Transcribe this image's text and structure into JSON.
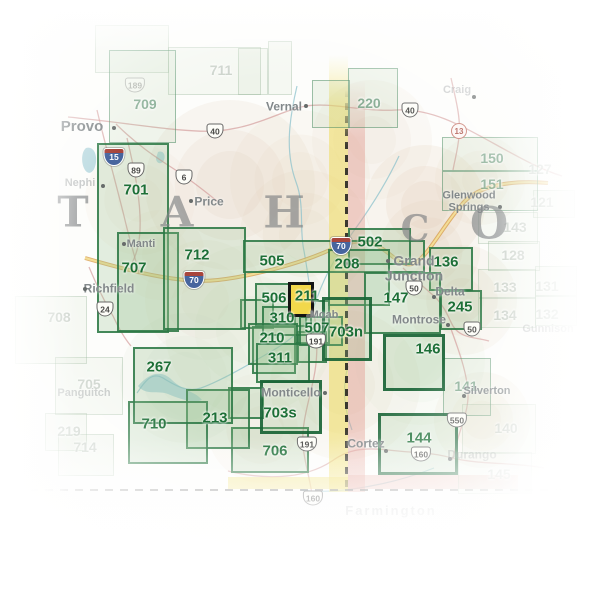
{
  "map": {
    "selected_map": "211",
    "colors": {
      "box_border": "#2c7a47",
      "box_label": "#1d6f37",
      "highlight_fill": "#f2d84b",
      "highlight_border": "#141414",
      "state_line_yellow": "#efdc5e",
      "state_line_pink": "#e2978c",
      "interstate_road": "#d79a46",
      "us_road": "#cf8f8f",
      "river": "#86bfca",
      "city_text": "#82888a",
      "state_letter": "#808385"
    },
    "state_letters": [
      {
        "char": "T",
        "x": 73,
        "y": 212,
        "size": 42
      },
      {
        "char": "A",
        "x": 177,
        "y": 212,
        "size": 42
      },
      {
        "char": "H",
        "x": 284,
        "y": 213,
        "size": 44
      },
      {
        "char": "C",
        "x": 415,
        "y": 229,
        "size": 36
      },
      {
        "char": "O",
        "x": 489,
        "y": 224,
        "size": 44
      }
    ],
    "boxes": [
      {
        "label": "711",
        "x": 168,
        "y": 47,
        "w": 93,
        "h": 48,
        "lx": 221,
        "ly": 70,
        "style": "ghost"
      },
      {
        "label": "705",
        "x": 55,
        "y": 357,
        "w": 68,
        "h": 58,
        "lx": 89,
        "ly": 384,
        "style": "ghost"
      },
      {
        "label": "708",
        "x": 15,
        "y": 296,
        "w": 72,
        "h": 68,
        "lx": 59,
        "ly": 317,
        "style": "ghost"
      },
      {
        "label": "219",
        "x": 45,
        "y": 413,
        "w": 42,
        "h": 38,
        "lx": 69,
        "ly": 431,
        "style": "ghost"
      },
      {
        "label": "714",
        "x": 58,
        "y": 434,
        "w": 56,
        "h": 42,
        "lx": 85,
        "ly": 447,
        "style": "ghost"
      },
      {
        "label": "143",
        "x": 478,
        "y": 212,
        "w": 60,
        "h": 32,
        "lx": 515,
        "ly": 227,
        "style": "ghost"
      },
      {
        "label": "128",
        "x": 488,
        "y": 241,
        "w": 52,
        "h": 30,
        "lx": 513,
        "ly": 255,
        "style": "ghost"
      },
      {
        "label": "133",
        "x": 478,
        "y": 269,
        "w": 58,
        "h": 29,
        "lx": 505,
        "ly": 287,
        "style": "ghost"
      },
      {
        "label": "134",
        "x": 478,
        "y": 298,
        "w": 58,
        "h": 30,
        "lx": 505,
        "ly": 315,
        "style": "ghost"
      },
      {
        "label": "140",
        "x": 462,
        "y": 404,
        "w": 74,
        "h": 50,
        "lx": 506,
        "ly": 428,
        "style": "ghost"
      },
      {
        "label": "145",
        "x": 458,
        "y": 452,
        "w": 74,
        "h": 42,
        "lx": 499,
        "ly": 474,
        "style": "ghost"
      },
      {
        "label": "121",
        "lx": 542,
        "ly": 202,
        "style": "label-only"
      },
      {
        "label": "127",
        "lx": 540,
        "ly": 169,
        "style": "label-only"
      },
      {
        "label": "131",
        "lx": 547,
        "ly": 286,
        "style": "label-only"
      },
      {
        "label": "132",
        "lx": 547,
        "ly": 314,
        "style": "label-only"
      },
      {
        "label": "709",
        "x": 109,
        "y": 50,
        "w": 67,
        "h": 93,
        "lx": 145,
        "ly": 104,
        "style": "medium"
      },
      {
        "label": "220",
        "x": 348,
        "y": 68,
        "w": 50,
        "h": 60,
        "lx": 369,
        "ly": 103,
        "style": "medium"
      },
      {
        "label": "150",
        "x": 442,
        "y": 137,
        "w": 96,
        "h": 34,
        "lx": 492,
        "ly": 158,
        "style": "medium"
      },
      {
        "label": "151",
        "x": 442,
        "y": 171,
        "w": 96,
        "h": 40,
        "lx": 492,
        "ly": 184,
        "style": "medium"
      },
      {
        "label": "141",
        "x": 443,
        "y": 358,
        "w": 48,
        "h": 58,
        "lx": 466,
        "ly": 386,
        "style": "medium"
      },
      {
        "label": "245",
        "x": 440,
        "y": 290,
        "w": 42,
        "h": 40,
        "lx": 460,
        "ly": 307,
        "style": "bold"
      },
      {
        "label": "701",
        "x": 97,
        "y": 143,
        "w": 72,
        "h": 190,
        "lx": 136,
        "ly": 190,
        "style": "bold"
      },
      {
        "label": "707",
        "x": 117,
        "y": 232,
        "w": 62,
        "h": 100,
        "lx": 134,
        "ly": 268,
        "style": "bold"
      },
      {
        "label": "712",
        "x": 163,
        "y": 227,
        "w": 83,
        "h": 103,
        "lx": 197,
        "ly": 255,
        "style": "bold"
      },
      {
        "label": "505",
        "x": 243,
        "y": 240,
        "w": 182,
        "h": 33,
        "lx": 272,
        "ly": 261,
        "style": "bold"
      },
      {
        "label": "502",
        "x": 348,
        "y": 228,
        "w": 63,
        "h": 37,
        "lx": 370,
        "ly": 242,
        "style": "bold"
      },
      {
        "label": "208",
        "x": 328,
        "y": 249,
        "w": 62,
        "h": 57,
        "lx": 347,
        "ly": 264,
        "style": "bold"
      },
      {
        "label": "136",
        "x": 429,
        "y": 247,
        "w": 44,
        "h": 44,
        "lx": 446,
        "ly": 262,
        "style": "bold"
      },
      {
        "label": "147",
        "x": 364,
        "y": 272,
        "w": 77,
        "h": 62,
        "lx": 396,
        "ly": 298,
        "style": "bold"
      },
      {
        "label": "146",
        "x": 383,
        "y": 334,
        "w": 62,
        "h": 57,
        "lx": 428,
        "ly": 349,
        "style": "thick"
      },
      {
        "label": "144",
        "x": 378,
        "y": 413,
        "w": 80,
        "h": 62,
        "lx": 419,
        "ly": 438,
        "style": "thick"
      },
      {
        "label": "506",
        "x": 255,
        "y": 283,
        "w": 52,
        "h": 44,
        "lx": 274,
        "ly": 298,
        "style": "bold"
      },
      {
        "label": "310",
        "x": 262,
        "y": 306,
        "w": 50,
        "h": 30,
        "lx": 282,
        "ly": 318,
        "style": "bold"
      },
      {
        "label": "210",
        "x": 248,
        "y": 323,
        "w": 50,
        "h": 42,
        "lx": 272,
        "ly": 338,
        "style": "bold"
      },
      {
        "label": "311",
        "x": 256,
        "y": 343,
        "w": 54,
        "h": 40,
        "lx": 280,
        "ly": 358,
        "style": "bold"
      },
      {
        "label": "507",
        "x": 299,
        "y": 316,
        "w": 44,
        "h": 30,
        "lx": 317,
        "ly": 328,
        "style": "bold"
      },
      {
        "label": "703n",
        "x": 322,
        "y": 297,
        "w": 50,
        "h": 64,
        "lx": 346,
        "ly": 332,
        "style": "thick"
      },
      {
        "label": "703s",
        "x": 260,
        "y": 380,
        "w": 62,
        "h": 54,
        "lx": 280,
        "ly": 413,
        "style": "thick"
      },
      {
        "label": "706",
        "x": 231,
        "y": 427,
        "w": 78,
        "h": 46,
        "lx": 275,
        "ly": 451,
        "style": "bold"
      },
      {
        "label": "213",
        "x": 186,
        "y": 389,
        "w": 64,
        "h": 60,
        "lx": 215,
        "ly": 418,
        "style": "bold"
      },
      {
        "label": "710",
        "x": 128,
        "y": 401,
        "w": 80,
        "h": 63,
        "lx": 154,
        "ly": 424,
        "style": "bold"
      },
      {
        "label": "267",
        "x": 133,
        "y": 347,
        "w": 100,
        "h": 77,
        "lx": 159,
        "ly": 367,
        "style": "bold"
      }
    ],
    "highlight": {
      "label": "211",
      "x": 288,
      "y": 282,
      "w": 26,
      "h": 35,
      "lx": 307,
      "ly": 296
    },
    "decor_rects": [
      {
        "x": 240,
        "y": 299,
        "w": 34,
        "h": 30,
        "style": "bold"
      },
      {
        "x": 294,
        "y": 300,
        "w": 36,
        "h": 44,
        "style": "bold"
      },
      {
        "x": 252,
        "y": 326,
        "w": 44,
        "h": 48,
        "style": "bold"
      },
      {
        "x": 297,
        "y": 331,
        "w": 30,
        "h": 32,
        "style": "bold"
      },
      {
        "x": 228,
        "y": 387,
        "w": 36,
        "h": 32,
        "style": "bold"
      },
      {
        "x": 312,
        "y": 80,
        "w": 38,
        "h": 48,
        "style": "medium"
      },
      {
        "x": 238,
        "y": 48,
        "w": 30,
        "h": 47,
        "style": "ghost"
      },
      {
        "x": 268,
        "y": 41,
        "w": 24,
        "h": 54,
        "style": "ghost"
      },
      {
        "x": 95,
        "y": 25,
        "w": 74,
        "h": 48,
        "style": "ghost"
      },
      {
        "x": 533,
        "y": 190,
        "w": 42,
        "h": 28,
        "style": "ghost"
      },
      {
        "x": 535,
        "y": 266,
        "w": 42,
        "h": 30,
        "style": "ghost"
      },
      {
        "x": 535,
        "y": 296,
        "w": 42,
        "h": 30,
        "style": "ghost"
      }
    ],
    "cities": [
      {
        "name": "Provo",
        "x": 82,
        "y": 127,
        "size": 15,
        "style": "normal",
        "dot": [
          114,
          128
        ]
      },
      {
        "name": "Nephi",
        "x": 80,
        "y": 184,
        "size": 11,
        "style": "faded",
        "dot": [
          103,
          186
        ]
      },
      {
        "name": "Price",
        "x": 209,
        "y": 202,
        "size": 12,
        "style": "normal",
        "dot": [
          191,
          201
        ]
      },
      {
        "name": "Manti",
        "x": 141,
        "y": 245,
        "size": 11,
        "style": "normal",
        "dot": [
          124,
          244
        ]
      },
      {
        "name": "Richfield",
        "x": 109,
        "y": 289,
        "size": 12,
        "style": "normal",
        "dot": [
          85,
          289
        ]
      },
      {
        "name": "Vernal",
        "x": 284,
        "y": 107,
        "size": 12,
        "style": "normal",
        "dot": [
          306,
          106
        ]
      },
      {
        "name": "Craig",
        "x": 457,
        "y": 91,
        "size": 11,
        "style": "faded",
        "dot": [
          474,
          97
        ]
      },
      {
        "name": "Glenwood\nSprings",
        "x": 469,
        "y": 202,
        "size": 11,
        "style": "normal",
        "dot": [
          500,
          207
        ]
      },
      {
        "name": "Grand\nJunction",
        "x": 414,
        "y": 268,
        "size": 14,
        "style": "normal",
        "dot": [
          388,
          261
        ]
      },
      {
        "name": "Delta",
        "x": 450,
        "y": 292,
        "size": 12,
        "style": "normal",
        "dot": [
          434,
          297
        ]
      },
      {
        "name": "Montrose",
        "x": 419,
        "y": 320,
        "size": 12,
        "style": "normal",
        "dot": [
          448,
          325
        ]
      },
      {
        "name": "Gunnison",
        "x": 548,
        "y": 330,
        "size": 11,
        "style": "faded"
      },
      {
        "name": "Silverton",
        "x": 487,
        "y": 392,
        "size": 11,
        "style": "normal",
        "dot": [
          464,
          396
        ]
      },
      {
        "name": "Moab",
        "x": 324,
        "y": 316,
        "size": 11,
        "style": "normal",
        "dot": [
          308,
          316
        ]
      },
      {
        "name": "Monticello",
        "x": 291,
        "y": 393,
        "size": 12,
        "style": "normal",
        "dot": [
          325,
          393
        ]
      },
      {
        "name": "Cortez",
        "x": 366,
        "y": 444,
        "size": 12,
        "style": "normal",
        "dot": [
          386,
          451
        ]
      },
      {
        "name": "Durango",
        "x": 472,
        "y": 455,
        "size": 12,
        "style": "faded",
        "dot": [
          450,
          459
        ]
      },
      {
        "name": "Panguitch",
        "x": 84,
        "y": 394,
        "size": 11,
        "style": "faded"
      },
      {
        "name": "Farmington",
        "x": 391,
        "y": 511,
        "size": 13,
        "style": "faded"
      }
    ],
    "shields": [
      {
        "kind": "i",
        "label": "15",
        "x": 114,
        "y": 157
      },
      {
        "kind": "i",
        "label": "70",
        "x": 194,
        "y": 280
      },
      {
        "kind": "i",
        "label": "70",
        "x": 341,
        "y": 246
      },
      {
        "kind": "us",
        "label": "40",
        "x": 215,
        "y": 131
      },
      {
        "kind": "us",
        "label": "40",
        "x": 410,
        "y": 110
      },
      {
        "kind": "us",
        "label": "6",
        "x": 184,
        "y": 177
      },
      {
        "kind": "us",
        "label": "89",
        "x": 136,
        "y": 170
      },
      {
        "kind": "us",
        "label": "189",
        "x": 135,
        "y": 85,
        "faded": true
      },
      {
        "kind": "us",
        "label": "24",
        "x": 105,
        "y": 309
      },
      {
        "kind": "us",
        "label": "191",
        "x": 316,
        "y": 341
      },
      {
        "kind": "us",
        "label": "191",
        "x": 307,
        "y": 444
      },
      {
        "kind": "us",
        "label": "50",
        "x": 414,
        "y": 288
      },
      {
        "kind": "us",
        "label": "50",
        "x": 472,
        "y": 329
      },
      {
        "kind": "us",
        "label": "550",
        "x": 457,
        "y": 420
      },
      {
        "kind": "us",
        "label": "160",
        "x": 421,
        "y": 454
      },
      {
        "kind": "us",
        "label": "160",
        "x": 313,
        "y": 498
      },
      {
        "kind": "state",
        "label": "13",
        "x": 459,
        "y": 131
      }
    ],
    "roads": [
      {
        "id": "i70",
        "kind": "interstate",
        "d": "M85,258 C140,274 185,284 218,280 C252,276 300,264 332,249 C347,242 362,239 374,244 C390,251 399,267 412,264 C426,261 442,226 464,202 C480,185 512,180 548,183"
      },
      {
        "id": "us6",
        "kind": "us",
        "d": "M116,124 C140,148 162,161 180,173 C196,184 207,193 217,201"
      },
      {
        "id": "us40",
        "kind": "us",
        "d": "M68,117 C130,123 182,133 216,131 C256,128 282,110 306,106 C332,102 362,112 396,110 C432,108 462,126 502,148 C522,159 542,170 562,176"
      },
      {
        "id": "i15",
        "kind": "us",
        "d": "M97,110 C104,140 115,180 124,216 C130,242 136,260 139,274"
      },
      {
        "id": "us89",
        "kind": "us",
        "d": "M127,138 C133,164 139,190 140,216 C141,241 137,253 132,263"
      },
      {
        "id": "us191",
        "kind": "us",
        "d": "M311,297 C316,320 319,346 315,371 C311,396 301,421 303,446 C305,466 311,481 313,502"
      },
      {
        "id": "us50",
        "kind": "us",
        "d": "M403,268 C416,281 429,291 437,299 C446,309 449,319 453,326 C461,339 476,337 489,341"
      },
      {
        "id": "us550",
        "kind": "us",
        "d": "M451,329 C459,351 467,373 468,393 C469,411 459,431 456,446 C454,453 453,457 452,460"
      },
      {
        "id": "us160",
        "kind": "us",
        "d": "M228,471 C260,479 302,481 332,461 C347,450 362,447 388,450 C412,453 432,452 452,458 C482,465 512,462 544,468"
      },
      {
        "id": "co13",
        "kind": "us",
        "d": "M451,78 C456,100 461,119 459,136 C458,149 455,159 453,170"
      },
      {
        "id": "ut24",
        "kind": "us",
        "d": "M89,267 C97,286 104,301 113,316 C119,329 125,339 131,346"
      }
    ],
    "rivers": [
      {
        "id": "green-river",
        "d": "M297,86 C289,120 285,152 296,182 C305,206 299,229 304,251 C308,273 309,286 312,298"
      },
      {
        "id": "colorado-river",
        "d": "M399,156 C386,184 369,210 353,232 C339,252 327,270 317,298 C309,322 297,336 277,348 C253,362 223,380 201,388 C186,393 173,384 163,378 C151,371 144,383 137,393"
      },
      {
        "id": "san-juan-river",
        "d": "M434,468 C409,478 381,485 353,489 C331,492 316,492 301,490"
      },
      {
        "id": "dolores-river",
        "d": "M352,430 C344,408 342,388 348,366"
      }
    ],
    "lakes": [
      {
        "id": "utah-lake",
        "d": "M86,148 C92,146 97,152 96,162 C95,172 89,176 85,170 C81,164 81,152 86,148"
      },
      {
        "id": "scofield",
        "d": "M158,152 C163,150 166,155 164,160 C162,165 156,164 156,158"
      },
      {
        "id": "lake-powell",
        "d": "M138,386 C150,372 162,370 172,380 C182,390 196,392 202,400 C192,404 178,398 168,394 C158,390 146,396 138,386"
      }
    ],
    "terrain_blobs": [
      {
        "x": 230,
        "y": 185,
        "r": 85,
        "c": "#dcc6ab",
        "o": 0.45
      },
      {
        "x": 305,
        "y": 235,
        "r": 65,
        "c": "#e2ccb2",
        "o": 0.4
      },
      {
        "x": 425,
        "y": 205,
        "r": 60,
        "c": "#dcc5aa",
        "o": 0.5
      },
      {
        "x": 462,
        "y": 300,
        "r": 55,
        "c": "#e0c9ae",
        "o": 0.4
      },
      {
        "x": 345,
        "y": 385,
        "r": 75,
        "c": "#dfc9ad",
        "o": 0.38
      },
      {
        "x": 205,
        "y": 300,
        "r": 60,
        "c": "#e5d2ba",
        "o": 0.35
      },
      {
        "x": 482,
        "y": 420,
        "r": 48,
        "c": "#dccaaf",
        "o": 0.4
      },
      {
        "x": 372,
        "y": 140,
        "r": 60,
        "c": "#e6d3bb",
        "o": 0.35
      },
      {
        "x": 262,
        "y": 428,
        "r": 55,
        "c": "#dbcbb4",
        "o": 0.3
      },
      {
        "x": 160,
        "y": 255,
        "r": 45,
        "c": "#e8d8c2",
        "o": 0.3
      },
      {
        "x": 300,
        "y": 180,
        "r": 70,
        "c": "#e0cdb4",
        "o": 0.35
      },
      {
        "x": 430,
        "y": 250,
        "r": 50,
        "c": "#dfc9ad",
        "o": 0.4
      },
      {
        "x": 250,
        "y": 330,
        "r": 85,
        "c": "#cfdfc5",
        "o": 0.45
      },
      {
        "x": 185,
        "y": 378,
        "r": 65,
        "c": "#d5e2cc",
        "o": 0.4
      },
      {
        "x": 420,
        "y": 360,
        "r": 65,
        "c": "#d2e0c8",
        "o": 0.35
      },
      {
        "x": 140,
        "y": 200,
        "r": 55,
        "c": "#e6d6c0",
        "o": 0.3
      },
      {
        "x": 480,
        "y": 180,
        "r": 45,
        "c": "#e3d0b8",
        "o": 0.35
      }
    ],
    "state_border": {
      "vertical": {
        "x": 329,
        "top": 55,
        "bottom": 492,
        "yellow_w": 19,
        "pink_w": 17,
        "dash_x": 345
      },
      "horizontal": {
        "y": 489,
        "left": 30,
        "right": 565,
        "yellow_x1": 228,
        "yellow_x2": 348,
        "pink_x2": 518
      }
    }
  }
}
